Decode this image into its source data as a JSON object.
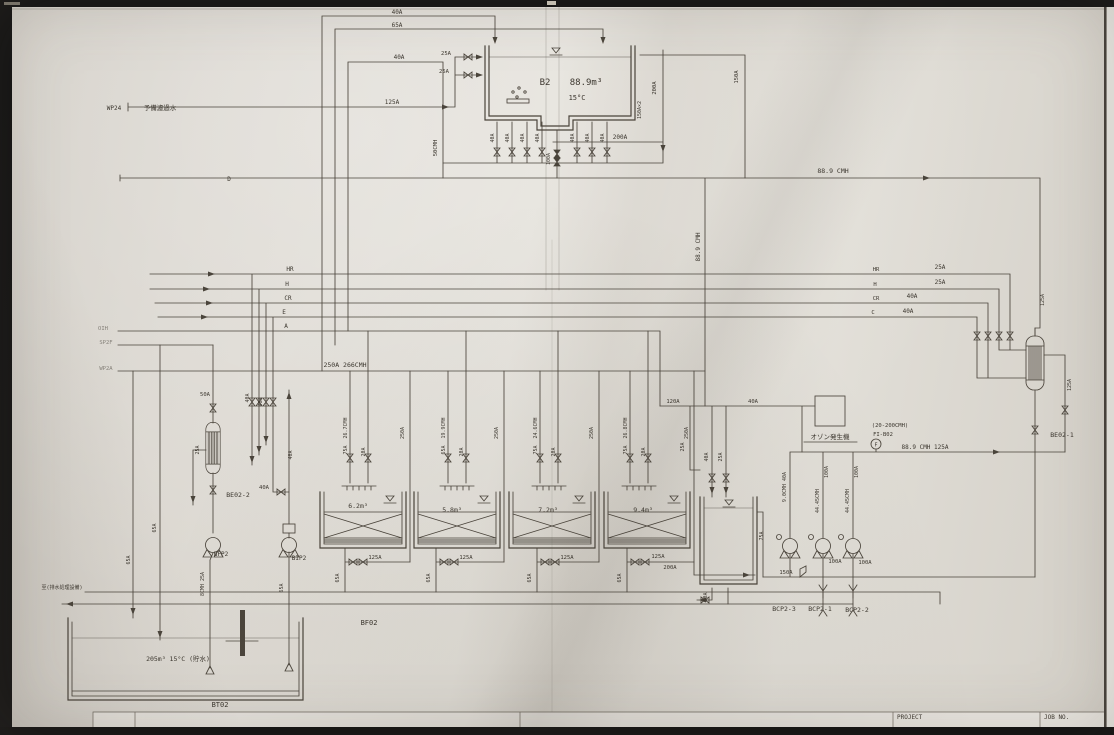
{
  "sheet": {
    "ink_color": "#4a443b",
    "paper_color": "#dad6cf",
    "title_block": {
      "project_label": "PROJECT",
      "job_no_label": "JOB NO."
    },
    "equipment_tags": [
      "B2",
      "BF02",
      "BT02",
      "BE02-1",
      "BE02-2",
      "BCP2-1",
      "BCP2-2",
      "BCP2-3",
      "BFP2",
      "BIP2",
      "FI-B02"
    ],
    "annotations": [
      {
        "name": "wp24-tag",
        "text": "WP24",
        "x": 114,
        "y": 110,
        "size": 6
      },
      {
        "name": "wp24-desc",
        "text": "予備濾過水",
        "x": 160,
        "y": 110,
        "size": 6.5
      },
      {
        "name": "wp24-pipe-size",
        "text": "125A",
        "x": 392,
        "y": 104,
        "size": 6
      },
      {
        "name": "line-d-tag",
        "text": "D",
        "x": 229,
        "y": 181,
        "size": 6
      },
      {
        "name": "loop-top-40a",
        "text": "40A",
        "x": 397,
        "y": 14,
        "size": 6
      },
      {
        "name": "loop-65a",
        "text": "65A",
        "x": 397,
        "y": 27,
        "size": 6
      },
      {
        "name": "loop-40a",
        "text": "40A",
        "x": 399,
        "y": 59,
        "size": 6
      },
      {
        "name": "b2-inlet-25a-upper",
        "text": "25A",
        "x": 446,
        "y": 55,
        "size": 5.5
      },
      {
        "name": "b2-inlet-25a-lower",
        "text": "25A",
        "x": 444,
        "y": 73,
        "size": 5.5
      },
      {
        "name": "b2-tag",
        "text": "B2",
        "x": 545,
        "y": 85,
        "size": 9
      },
      {
        "name": "b2-volume",
        "text": "88.9m³",
        "x": 586,
        "y": 85,
        "size": 9
      },
      {
        "name": "b2-temp",
        "text": "15°C",
        "x": 577,
        "y": 100,
        "size": 7
      },
      {
        "name": "b2-left-50cmh",
        "text": "50CMH",
        "x": 437,
        "y": 148,
        "size": 5.5,
        "rot": -90
      },
      {
        "name": "b2-outlet-40a-1",
        "text": "40A",
        "x": 494,
        "y": 138,
        "size": 5,
        "rot": -90
      },
      {
        "name": "b2-outlet-40a-2",
        "text": "40A",
        "x": 509,
        "y": 138,
        "size": 5,
        "rot": -90
      },
      {
        "name": "b2-outlet-40a-3",
        "text": "40A",
        "x": 524,
        "y": 138,
        "size": 5,
        "rot": -90
      },
      {
        "name": "b2-outlet-40a-4",
        "text": "40A",
        "x": 539,
        "y": 138,
        "size": 5,
        "rot": -90
      },
      {
        "name": "b2-outlet-100a",
        "text": "100A",
        "x": 550,
        "y": 159,
        "size": 5,
        "rot": -90
      },
      {
        "name": "b2-outlet-40a-5",
        "text": "40A",
        "x": 574,
        "y": 138,
        "size": 5,
        "rot": -90
      },
      {
        "name": "b2-outlet-40a-6",
        "text": "40A",
        "x": 589,
        "y": 138,
        "size": 5,
        "rot": -90
      },
      {
        "name": "b2-outlet-40a-7",
        "text": "40A",
        "x": 604,
        "y": 138,
        "size": 5,
        "rot": -90
      },
      {
        "name": "b2-200a-line",
        "text": "200A",
        "x": 620,
        "y": 139,
        "size": 6
      },
      {
        "name": "b2-200a-riser",
        "text": "200A",
        "x": 656,
        "y": 88,
        "size": 5.5,
        "rot": -90
      },
      {
        "name": "b2-150a-riser",
        "text": "150A",
        "x": 738,
        "y": 77,
        "size": 5.5,
        "rot": -90
      },
      {
        "name": "b2-150a-x2",
        "text": "150A×2",
        "x": 641,
        "y": 110,
        "size": 5,
        "rot": -90
      },
      {
        "name": "overflow-cmh",
        "text": "88.9 CMH",
        "x": 833,
        "y": 173,
        "size": 6.5
      },
      {
        "name": "downcomer-cmh",
        "text": "88.9 CMH",
        "x": 700,
        "y": 247,
        "size": 6,
        "rot": -90
      },
      {
        "name": "line-hr-tag",
        "text": "HR",
        "x": 290,
        "y": 271,
        "size": 6
      },
      {
        "name": "line-h-tag",
        "text": "H",
        "x": 287,
        "y": 286,
        "size": 6
      },
      {
        "name": "line-cr-tag",
        "text": "CR",
        "x": 288,
        "y": 300,
        "size": 6
      },
      {
        "name": "line-e-tag",
        "text": "E",
        "x": 284,
        "y": 314,
        "size": 6
      },
      {
        "name": "line-a-tag",
        "text": "A",
        "x": 286,
        "y": 328,
        "size": 6
      },
      {
        "name": "margin-oih",
        "text": "OIH",
        "x": 103,
        "y": 330,
        "size": 5.5,
        "faint": true
      },
      {
        "name": "margin-sp2f",
        "text": "SP2F",
        "x": 106,
        "y": 344,
        "size": 5.5,
        "faint": true
      },
      {
        "name": "margin-wp2a",
        "text": "WP2A",
        "x": 106,
        "y": 370,
        "size": 5.5,
        "faint": true
      },
      {
        "name": "header-250a",
        "text": "250A 266CMH",
        "x": 345,
        "y": 367,
        "size": 6.5
      },
      {
        "name": "r-hr-tag",
        "text": "HR",
        "x": 876,
        "y": 271,
        "size": 5.5
      },
      {
        "name": "r-hr-size",
        "text": "25A",
        "x": 940,
        "y": 269,
        "size": 6
      },
      {
        "name": "r-h-tag",
        "text": "H",
        "x": 875,
        "y": 286,
        "size": 5.5
      },
      {
        "name": "r-h-size",
        "text": "25A",
        "x": 940,
        "y": 284,
        "size": 6
      },
      {
        "name": "r-cr-tag",
        "text": "CR",
        "x": 876,
        "y": 300,
        "size": 5.5
      },
      {
        "name": "r-cr-size",
        "text": "40A",
        "x": 912,
        "y": 298,
        "size": 6
      },
      {
        "name": "r-c-tag",
        "text": "C",
        "x": 873,
        "y": 314,
        "size": 5.5
      },
      {
        "name": "r-c-size",
        "text": "40A",
        "x": 908,
        "y": 313,
        "size": 6
      },
      {
        "name": "f1-cmh",
        "text": "26.7CMH",
        "x": 347,
        "y": 428,
        "size": 5,
        "rot": -90
      },
      {
        "name": "f1-75a",
        "text": "75A",
        "x": 347,
        "y": 450,
        "size": 5,
        "rot": -90
      },
      {
        "name": "f1-20a",
        "text": "20A",
        "x": 365,
        "y": 452,
        "size": 5,
        "rot": -90
      },
      {
        "name": "f2-cmh",
        "text": "19.9CMH",
        "x": 445,
        "y": 428,
        "size": 5,
        "rot": -90
      },
      {
        "name": "f2-65a",
        "text": "65A",
        "x": 445,
        "y": 450,
        "size": 5,
        "rot": -90
      },
      {
        "name": "f2-20a",
        "text": "20A",
        "x": 463,
        "y": 452,
        "size": 5,
        "rot": -90
      },
      {
        "name": "f3-cmh",
        "text": "24.6CMH",
        "x": 537,
        "y": 428,
        "size": 5,
        "rot": -90
      },
      {
        "name": "f3-75a",
        "text": "75A",
        "x": 537,
        "y": 450,
        "size": 5,
        "rot": -90
      },
      {
        "name": "f3-20a",
        "text": "20A",
        "x": 555,
        "y": 452,
        "size": 5,
        "rot": -90
      },
      {
        "name": "f4-cmh",
        "text": "26.8CMH",
        "x": 627,
        "y": 428,
        "size": 5,
        "rot": -90
      },
      {
        "name": "f4-75a",
        "text": "75A",
        "x": 627,
        "y": 450,
        "size": 5,
        "rot": -90
      },
      {
        "name": "f4-20a",
        "text": "20A",
        "x": 645,
        "y": 452,
        "size": 5,
        "rot": -90
      },
      {
        "name": "riser1-250a",
        "text": "250A",
        "x": 404,
        "y": 433,
        "size": 5,
        "rot": -90
      },
      {
        "name": "riser2-250a",
        "text": "250A",
        "x": 498,
        "y": 433,
        "size": 5,
        "rot": -90
      },
      {
        "name": "riser3-250a",
        "text": "250A",
        "x": 593,
        "y": 433,
        "size": 5,
        "rot": -90
      },
      {
        "name": "riser4-250a",
        "text": "250A",
        "x": 688,
        "y": 433,
        "size": 5,
        "rot": -90
      },
      {
        "name": "f1-volume",
        "text": "6.2m³",
        "x": 358,
        "y": 508,
        "size": 6.5
      },
      {
        "name": "f2-volume",
        "text": "5.8m³",
        "x": 452,
        "y": 512,
        "size": 6.5
      },
      {
        "name": "f3-volume",
        "text": "7.2m³",
        "x": 548,
        "y": 512,
        "size": 6.5
      },
      {
        "name": "f4-volume",
        "text": "9.4m³",
        "x": 643,
        "y": 512,
        "size": 6.5
      },
      {
        "name": "d1-65a",
        "text": "65A",
        "x": 339,
        "y": 578,
        "size": 5,
        "rot": -90
      },
      {
        "name": "d2-65a",
        "text": "65A",
        "x": 430,
        "y": 578,
        "size": 5,
        "rot": -90
      },
      {
        "name": "d3-65a",
        "text": "65A",
        "x": 531,
        "y": 578,
        "size": 5,
        "rot": -90
      },
      {
        "name": "d4-65a",
        "text": "65A",
        "x": 621,
        "y": 578,
        "size": 5,
        "rot": -90
      },
      {
        "name": "d1-125a",
        "text": "125A",
        "x": 375,
        "y": 559,
        "size": 5.5
      },
      {
        "name": "d2-125a",
        "text": "125A",
        "x": 466,
        "y": 559,
        "size": 5.5
      },
      {
        "name": "d3-125a",
        "text": "125A",
        "x": 567,
        "y": 559,
        "size": 5.5
      },
      {
        "name": "d4-125a",
        "text": "125A",
        "x": 658,
        "y": 558,
        "size": 5.5
      },
      {
        "name": "d4-200a",
        "text": "200A",
        "x": 670,
        "y": 569,
        "size": 5.5
      },
      {
        "name": "bf02-tag",
        "text": "BF02",
        "x": 369,
        "y": 625,
        "size": 7
      },
      {
        "name": "rt-25a",
        "text": "25A",
        "x": 684,
        "y": 447,
        "size": 5,
        "rot": -90
      },
      {
        "name": "rt-40a",
        "text": "40A",
        "x": 708,
        "y": 457,
        "size": 5,
        "rot": -90
      },
      {
        "name": "rt-25a-2",
        "text": "25A",
        "x": 722,
        "y": 457,
        "size": 5,
        "rot": -90
      },
      {
        "name": "rt-75a",
        "text": "75A",
        "x": 763,
        "y": 536,
        "size": 5,
        "rot": -90
      },
      {
        "name": "rt-50a",
        "text": "50A",
        "x": 707,
        "y": 597,
        "size": 5,
        "rot": -90
      },
      {
        "name": "line-120a",
        "text": "120A",
        "x": 673,
        "y": 403,
        "size": 5.5
      },
      {
        "name": "line-40a",
        "text": "40A",
        "x": 753,
        "y": 403,
        "size": 5.5
      },
      {
        "name": "ozone-label",
        "text": "オゾン発生機",
        "x": 830,
        "y": 439,
        "size": 6.5
      },
      {
        "name": "fi-range",
        "text": "(20-200CMH)",
        "x": 890,
        "y": 427,
        "size": 5.5
      },
      {
        "name": "fi-tag",
        "text": "FI-B02",
        "x": 883,
        "y": 436,
        "size": 5.5
      },
      {
        "name": "fi-letter",
        "text": "F",
        "x": 876,
        "y": 446.5,
        "size": 5
      },
      {
        "name": "pump-header-size",
        "text": "88.9 CMH 125A",
        "x": 925,
        "y": 449,
        "size": 6
      },
      {
        "name": "bcp3-riser",
        "text": "9.0CMH 40A",
        "x": 786,
        "y": 487,
        "size": 5,
        "rot": -90
      },
      {
        "name": "bcp1-riser-100a",
        "text": "100A",
        "x": 828,
        "y": 472,
        "size": 5,
        "rot": -90
      },
      {
        "name": "bcp1-riser-cmh",
        "text": "44.45CMH",
        "x": 819,
        "y": 501,
        "size": 5,
        "rot": -90
      },
      {
        "name": "bcp2-riser-100a",
        "text": "100A",
        "x": 858,
        "y": 472,
        "size": 5,
        "rot": -90
      },
      {
        "name": "bcp2-riser-cmh",
        "text": "44.45CMH",
        "x": 849,
        "y": 501,
        "size": 5,
        "rot": -90
      },
      {
        "name": "suction-150a",
        "text": "150A",
        "x": 786,
        "y": 574,
        "size": 5.5
      },
      {
        "name": "bcp1-suction-100a",
        "text": "100A",
        "x": 835,
        "y": 563,
        "size": 5.5
      },
      {
        "name": "bcp2-suction-100a",
        "text": "100A",
        "x": 865,
        "y": 564,
        "size": 5.5
      },
      {
        "name": "bcp2-3-tag",
        "text": "BCP2-3",
        "x": 784,
        "y": 611,
        "size": 6.5
      },
      {
        "name": "bcp2-1-tag",
        "text": "BCP2-1",
        "x": 820,
        "y": 611,
        "size": 6.5
      },
      {
        "name": "bcp2-2-tag",
        "text": "BCP2-2",
        "x": 857,
        "y": 612,
        "size": 6.5
      },
      {
        "name": "be02-1-inlet-125a",
        "text": "125A",
        "x": 1044,
        "y": 300,
        "size": 5,
        "rot": -90
      },
      {
        "name": "be02-1-loop-125a",
        "text": "125A",
        "x": 1071,
        "y": 385,
        "size": 5,
        "rot": -90
      },
      {
        "name": "be02-1-tag",
        "text": "BE02-1",
        "x": 1062,
        "y": 437,
        "size": 6.5
      },
      {
        "name": "be02-2-50a",
        "text": "50A",
        "x": 205,
        "y": 396,
        "size": 5.5
      },
      {
        "name": "be02-2-25a",
        "text": "25A",
        "x": 199,
        "y": 450,
        "size": 5,
        "rot": -90
      },
      {
        "name": "lriser-40a-1",
        "text": "40A",
        "x": 249,
        "y": 398,
        "size": 5,
        "rot": -90
      },
      {
        "name": "lriser-40a-2",
        "text": "40A",
        "x": 262,
        "y": 402,
        "size": 5,
        "rot": -90
      },
      {
        "name": "be02-2-tag",
        "text": "BE02-2",
        "x": 238,
        "y": 497,
        "size": 6.5
      },
      {
        "name": "bip2-valve-40a",
        "text": "40A",
        "x": 264,
        "y": 489,
        "size": 5.5
      },
      {
        "name": "bip2-riser-40a",
        "text": "40A",
        "x": 292,
        "y": 455,
        "size": 5,
        "rot": -90
      },
      {
        "name": "bfp2-tag",
        "text": "BFP2",
        "x": 221,
        "y": 556,
        "size": 6
      },
      {
        "name": "bip2-tag",
        "text": "BIP2",
        "x": 299,
        "y": 560,
        "size": 6
      },
      {
        "name": "bfp2-suction",
        "text": "8CMH 25A",
        "x": 204,
        "y": 584,
        "size": 5,
        "rot": -90
      },
      {
        "name": "bip2-suction-65a",
        "text": "65A",
        "x": 283,
        "y": 588,
        "size": 5,
        "rot": -90
      },
      {
        "name": "left-riser-65a-1",
        "text": "65A",
        "x": 130,
        "y": 560,
        "size": 5,
        "rot": -90
      },
      {
        "name": "left-riser-65a-2",
        "text": "65A",
        "x": 156,
        "y": 528,
        "size": 5,
        "rot": -90
      },
      {
        "name": "drain-note",
        "text": "至(排水処理設備)",
        "x": 62,
        "y": 589,
        "size": 5
      },
      {
        "name": "bt02-volume",
        "text": "205m³ 15°C (貯水)",
        "x": 178,
        "y": 661,
        "size": 6.5
      },
      {
        "name": "bt02-tag",
        "text": "BT02",
        "x": 220,
        "y": 707,
        "size": 7
      }
    ]
  }
}
